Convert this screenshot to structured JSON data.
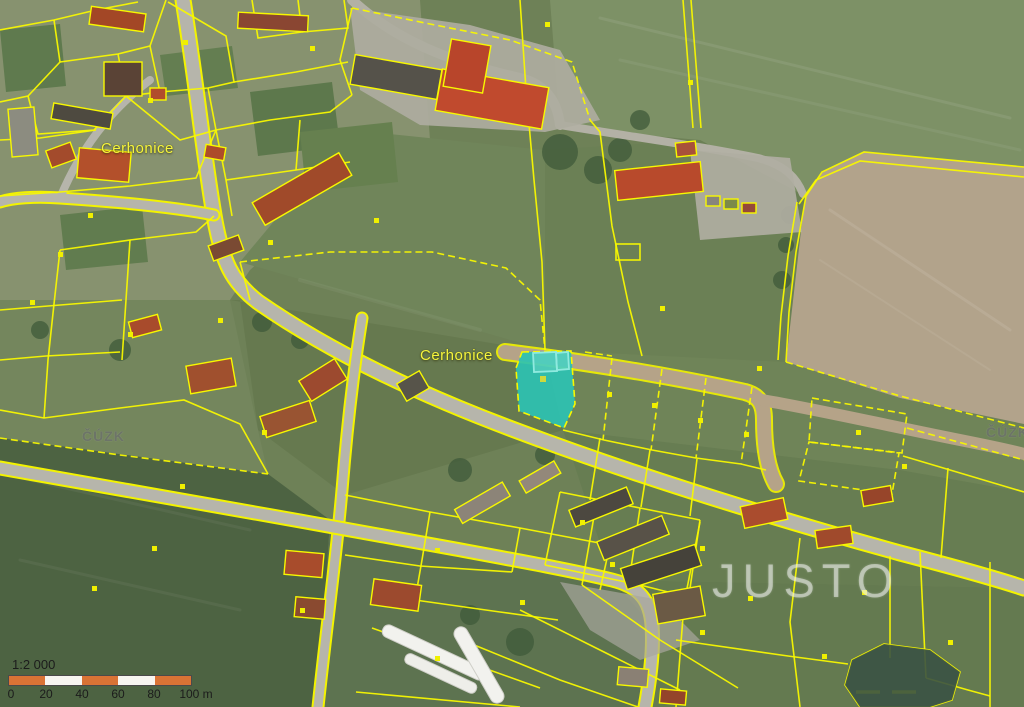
{
  "map": {
    "region_labels": [
      {
        "text": "Cerhonice"
      },
      {
        "text": "Cerhonice"
      }
    ],
    "watermarks": {
      "provider_left": "ČÚZK",
      "provider_right": "ČÚZK",
      "brand": "JUSTO"
    },
    "scale_bar": {
      "ratio": "1:2 000",
      "ticks": [
        "0",
        "20",
        "40",
        "60",
        "80",
        "100 m"
      ]
    },
    "colors": {
      "parcel_line": "#f8f800",
      "highlight_fill": "#2cc2b2",
      "scale_orange": "#d97335",
      "plowed_field": "#b2a38b",
      "road": "#b6b5ab"
    },
    "highlighted_parcel": {
      "highlighted": true,
      "has_building_outline": true
    }
  }
}
